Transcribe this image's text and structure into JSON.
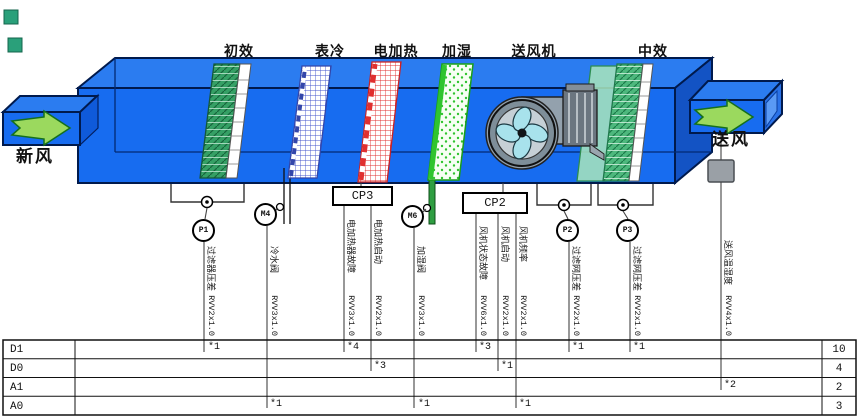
{
  "colors": {
    "unit_blue_front": "#176cf0",
    "unit_blue_top": "#2b7cf0",
    "unit_blue_side": "#1353c4",
    "edge_navy": "#001a4d",
    "arrow_green": "#9bd95e",
    "filter_green": "#35a065",
    "coil_grid_blue": "#4455cc",
    "heater_grid_red": "#e03030",
    "humidifier_green": "#2fc42f",
    "fan_gray": "#93a1ad",
    "fan_blade_cyan": "#a8e2ec",
    "sensor_box_gray": "#9aa0a6"
  },
  "sections": [
    {
      "label": "初效"
    },
    {
      "label": "表冷"
    },
    {
      "label": "电加热"
    },
    {
      "label": "加湿"
    },
    {
      "label": "送风机"
    },
    {
      "label": "中效"
    }
  ],
  "airflow": {
    "inlet": "新风",
    "outlet": "送风"
  },
  "controllers": [
    {
      "label": "CP3"
    },
    {
      "label": "CP2"
    }
  ],
  "sensors": [
    {
      "label": "P1"
    },
    {
      "label": "M4"
    },
    {
      "label": "M6"
    },
    {
      "label": "P2"
    },
    {
      "label": "P3"
    }
  ],
  "wires": [
    {
      "name": "过滤器压差",
      "cable": "RVV2x1.0",
      "row": "D1",
      "star": "*1"
    },
    {
      "name": "冷水阀",
      "cable": "RVV3x1.0",
      "row": "A0",
      "star": "*1"
    },
    {
      "name": "电加热器故障",
      "cable": "RVV3x1.0",
      "row": "D1",
      "star": "*4"
    },
    {
      "name": "电加热启动",
      "cable": "RVV2x1.0",
      "row": "D0",
      "star": "*3"
    },
    {
      "name": "加湿阀",
      "cable": "RVV3x1.0",
      "row": "A0",
      "star": "*1"
    },
    {
      "name": "风机状态故障",
      "cable": "RVV6x1.0",
      "row": "D1",
      "star": "*3"
    },
    {
      "name": "风机启动",
      "cable": "RVV2x1.0",
      "row": "D0",
      "star": "*1"
    },
    {
      "name": "风机频率",
      "cable": "RVV2x1.0",
      "row": "A0",
      "star": "*1"
    },
    {
      "name": "过滤网压差",
      "cable": "RVV2x1.0",
      "row": "D1",
      "star": "*1"
    },
    {
      "name": "过滤网压差",
      "cable": "RVV2x1.0",
      "row": "D1",
      "star": "*1"
    },
    {
      "name": "送风温湿度",
      "cable": "RVV4x1.0",
      "row": "A1",
      "star": "*2"
    }
  ],
  "io_table": {
    "rows": [
      {
        "label": "D1",
        "total": "10"
      },
      {
        "label": "D0",
        "total": "4"
      },
      {
        "label": "A1",
        "total": "2"
      },
      {
        "label": "A0",
        "total": "3"
      }
    ]
  }
}
